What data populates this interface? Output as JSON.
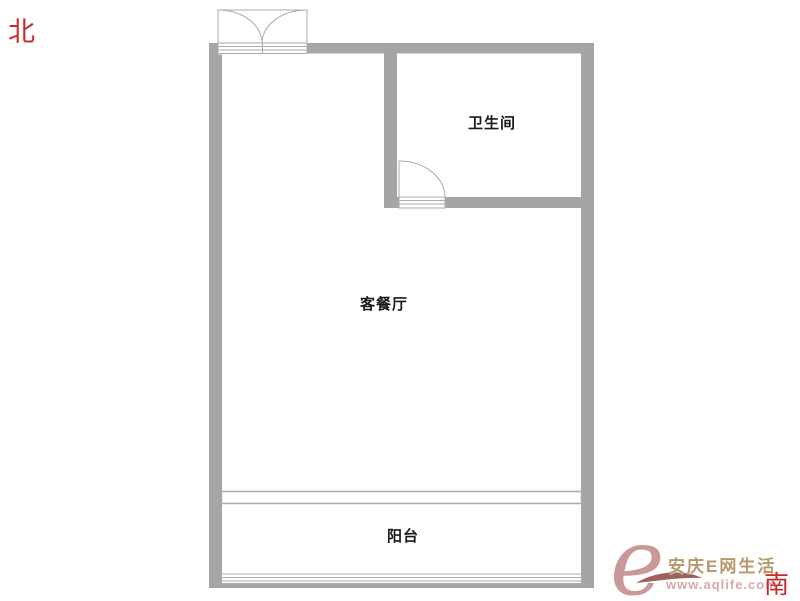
{
  "compass": {
    "north": "北",
    "south": "南"
  },
  "rooms": {
    "bathroom": "卫生间",
    "living_dining": "客餐厅",
    "balcony": "阳台"
  },
  "watermark": {
    "logo_letter": "e",
    "site_name": "安庆E网生活",
    "url": "www.aqlife.com"
  },
  "colors": {
    "wall": "#a5a5a5",
    "plan_line": "#ababab",
    "room_label": "#1a1a1a",
    "compass_red": "#c92b2b",
    "logo_rose": "#c48f8f",
    "site_gold": "#b5986a",
    "url_pink": "#d8a8a8",
    "swoosh_maroon": "#8e4444"
  }
}
